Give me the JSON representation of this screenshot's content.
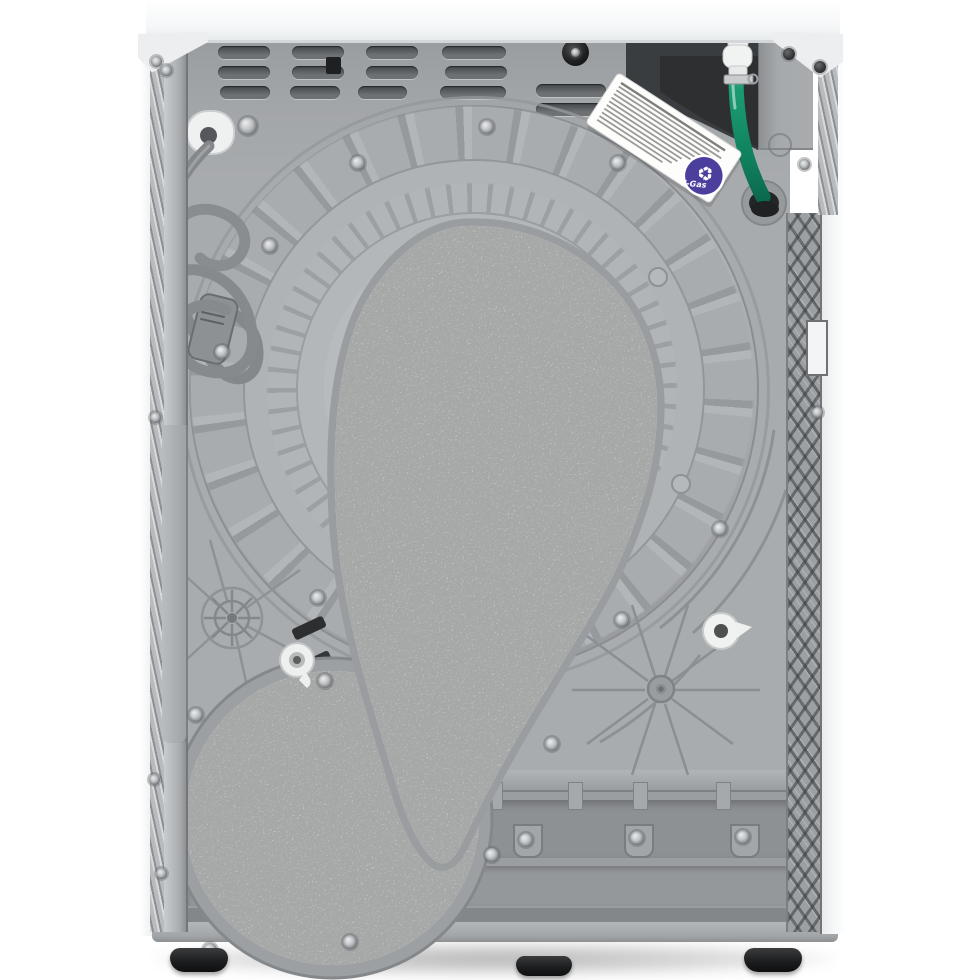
{
  "scene": {
    "subject": "Rear view of a white freestanding tumble dryer (product photo on white background)"
  },
  "palette": {
    "background": "#ffffff",
    "worktop_white": "#f7f9fa",
    "panel_gray": "#a7aaad",
    "drum_gray": "#afb2b5",
    "felt_gray": "#dcdbd8",
    "base_gray": "#9b9ea1",
    "cord_gray": "#878a8d",
    "hose_green": "#16946c",
    "hose_mint": "#a8dcc9",
    "badge_blue": "#4b3f9e",
    "label_white": "#fdfdfc",
    "recess_dark": "#3a3d40",
    "feet_black": "#26282a"
  },
  "label": {
    "badge_text": "F-Gas",
    "badge_icon_glyph": "♻",
    "text_lines": 11
  },
  "parts": [
    "worktop",
    "ventilation-grille",
    "power-cord",
    "power-plug",
    "cord-grommet",
    "f-gas-label",
    "drain-hose",
    "hose-connector",
    "hose-clamp",
    "terminal-recess",
    "terminal-box",
    "drum-back",
    "felt-pad",
    "felt-disc",
    "base-panel",
    "adjustable-feet"
  ]
}
